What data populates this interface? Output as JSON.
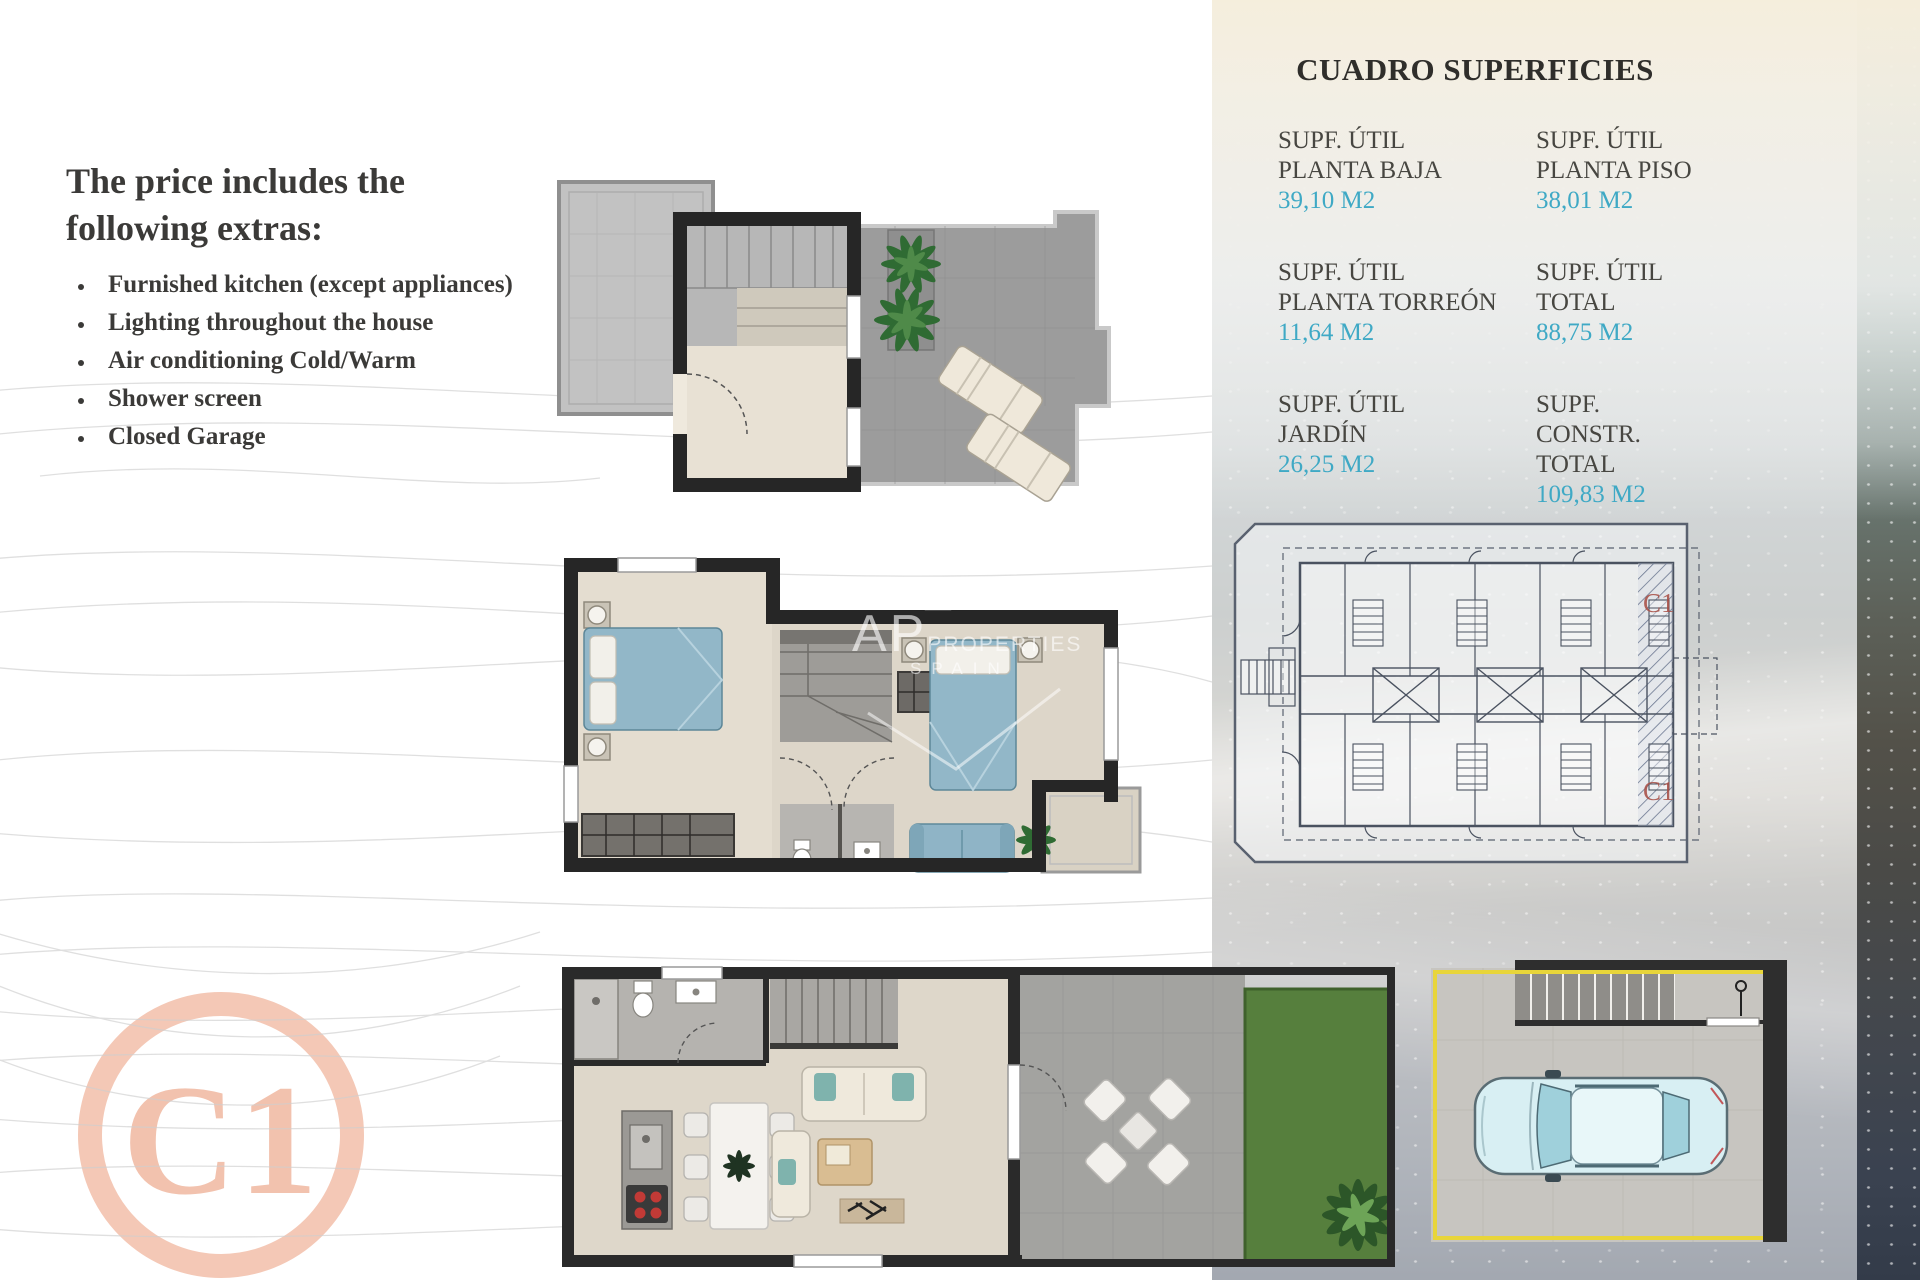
{
  "intro": {
    "heading": "The price includes the following extras:",
    "bullets": [
      "Furnished kitchen (except appliances)",
      "Lighting throughout the house",
      "Air conditioning Cold/Warm",
      "Shower screen",
      "Closed Garage"
    ]
  },
  "surfaces": {
    "title": "CUADRO SUPERFICIES",
    "cells": [
      {
        "l1": "SUPF. ÚTIL",
        "l2": "PLANTA BAJA",
        "value": "39,10 M2"
      },
      {
        "l1": "SUPF. ÚTIL",
        "l2": "PLANTA PISO",
        "value": "38,01 M2"
      },
      {
        "l1": "SUPF. ÚTIL",
        "l2": "PLANTA TORREÓN",
        "value": "11,64 M2"
      },
      {
        "l1": "SUPF. ÚTIL",
        "l2": "TOTAL",
        "value": "88,75 M2"
      },
      {
        "l1": "SUPF. ÚTIL",
        "l2": "JARDÍN",
        "value": "26,25 M2"
      },
      {
        "l1": "SUPF. CONSTR.",
        "l2": "TOTAL",
        "value": "109,83 M2"
      }
    ]
  },
  "unit_badge": "C1",
  "site_plan": {
    "unit_label_top": "C1",
    "unit_label_bottom": "C1"
  },
  "watermark": {
    "ap": "AP",
    "properties": "PROPERTIES",
    "spain": "SPAIN"
  },
  "colors": {
    "value_cyan": "#3fa9c5",
    "label_dark": "#474641",
    "badge_salmon": "#f2c2ae",
    "plan_red": "#a84f46",
    "garage_yellow": "#e8d53a",
    "bed_blue": "#92b7c8",
    "garden_green": "#567f3d"
  }
}
